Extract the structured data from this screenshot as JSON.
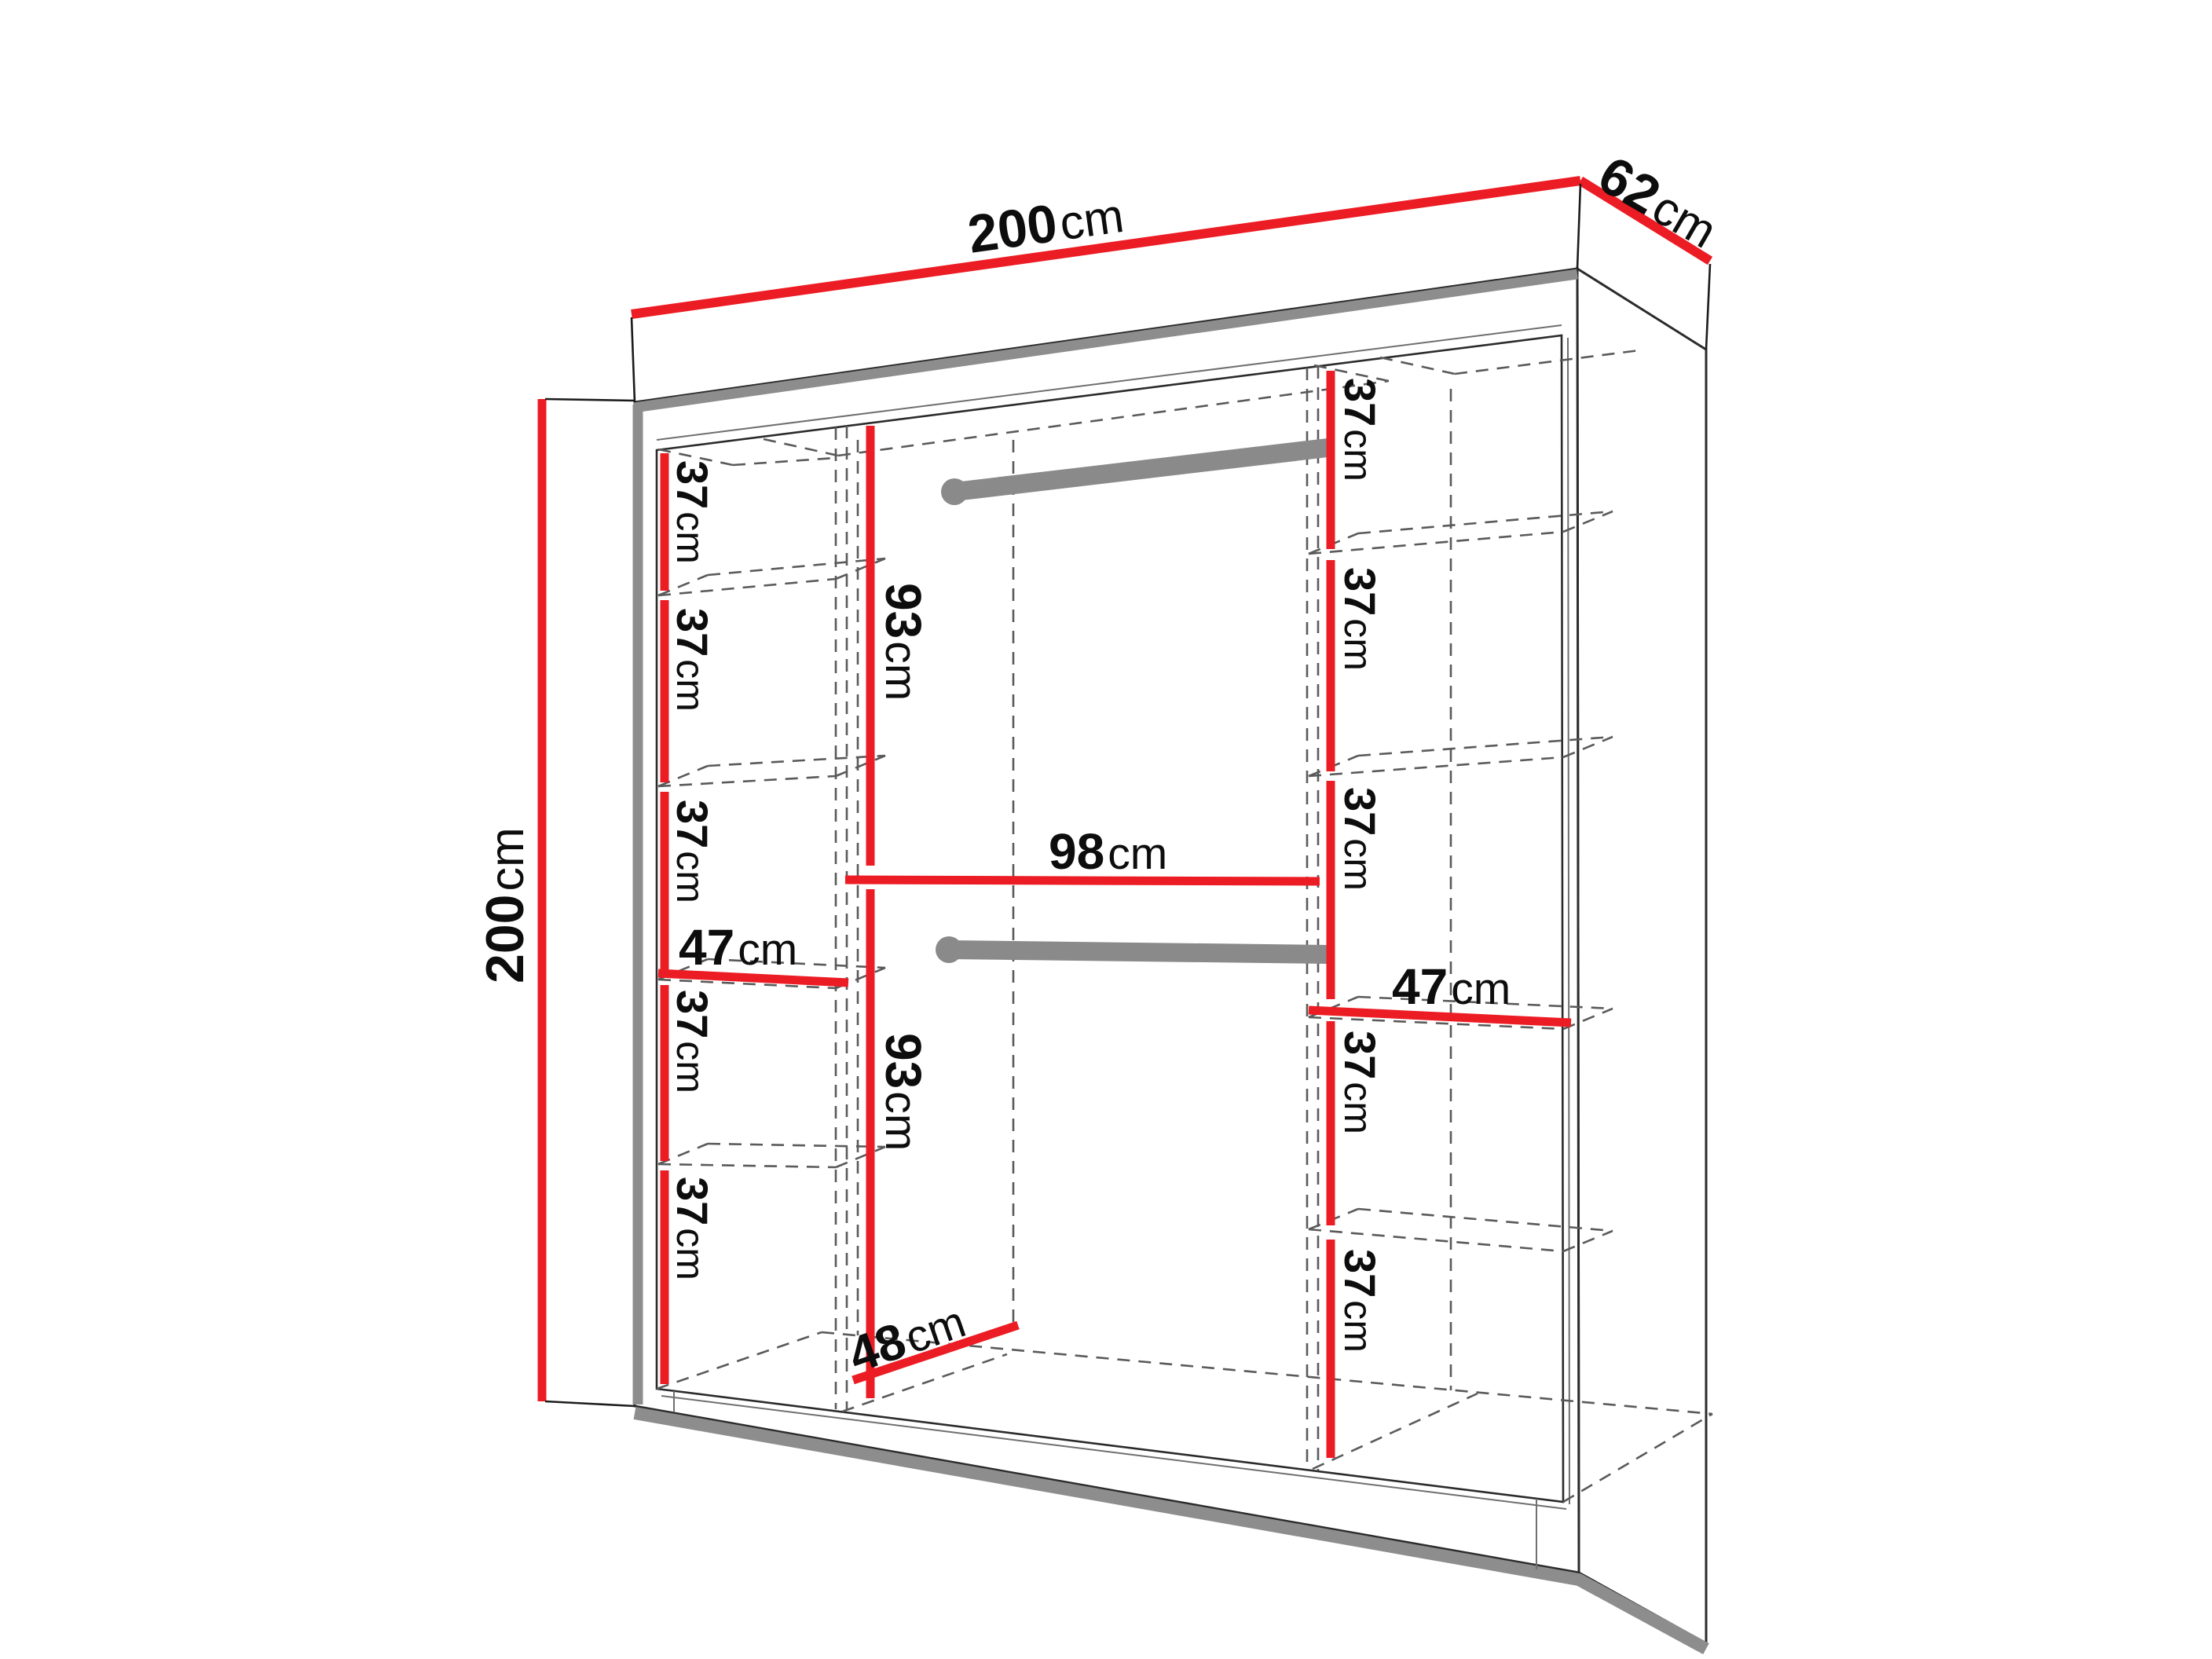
{
  "diagram_type": "wardrobe-dimension-diagram",
  "units": "cm",
  "overall_dimensions": {
    "width_cm": 200,
    "depth_cm": 62,
    "height_cm": 200
  },
  "labels": {
    "width": {
      "n": "200",
      "u": "cm"
    },
    "depth": {
      "n": "62",
      "u": "cm"
    },
    "height": {
      "n": "200",
      "u": "cm"
    },
    "left_column": {
      "shelves": [
        {
          "n": "37",
          "u": "cm"
        },
        {
          "n": "37",
          "u": "cm"
        },
        {
          "n": "37",
          "u": "cm"
        },
        {
          "n": "37",
          "u": "cm"
        },
        {
          "n": "37",
          "u": "cm"
        }
      ],
      "width": {
        "n": "47",
        "u": "cm"
      }
    },
    "middle_column": {
      "hanging_top": {
        "n": "93",
        "u": "cm"
      },
      "width": {
        "n": "98",
        "u": "cm"
      },
      "hanging_bottom": {
        "n": "93",
        "u": "cm"
      },
      "depth": {
        "n": "48",
        "u": "cm"
      }
    },
    "right_column": {
      "shelves": [
        {
          "n": "37",
          "u": "cm"
        },
        {
          "n": "37",
          "u": "cm"
        },
        {
          "n": "37",
          "u": "cm"
        },
        {
          "n": "37",
          "u": "cm"
        },
        {
          "n": "37",
          "u": "cm"
        }
      ],
      "width": {
        "n": "47",
        "u": "cm"
      }
    }
  },
  "colors": {
    "dimension_red": "#ec1c24",
    "rod_gray": "#8a8a8a",
    "edge_gray": "#8d8d8d",
    "dashed_gray": "#5a5a5a",
    "outline": "#2b2b2b",
    "background": "#ffffff"
  }
}
